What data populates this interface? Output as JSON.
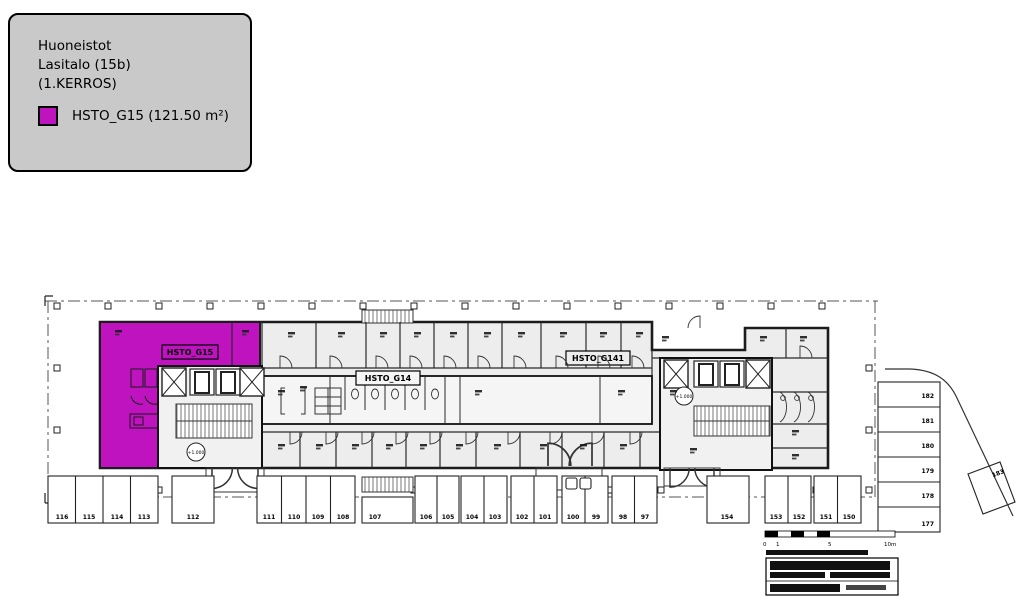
{
  "legend": {
    "title_lines": [
      "Huoneistot",
      "Lasitalo (15b)",
      "(1.KERROS)"
    ],
    "swatch_label": "HSTO_G15 (121.50 m²)",
    "swatch_color": "#c013c0"
  },
  "plan": {
    "unit_labels": {
      "g15": "HSTO_G15",
      "g14": "HSTO_G14",
      "g141": "HSTO_G141"
    },
    "level_marks": [
      "+1.000",
      "+1.000"
    ],
    "parking": {
      "bottom": [
        "116",
        "115",
        "114",
        "113",
        "112",
        "111",
        "110",
        "109",
        "108",
        "107",
        "106",
        "105",
        "104",
        "103",
        "102",
        "101",
        "100",
        "99",
        "98",
        "97",
        "154",
        "153",
        "152",
        "151",
        "150"
      ],
      "right": [
        "182",
        "181",
        "180",
        "179",
        "178",
        "177"
      ],
      "angled": "183"
    },
    "scalebar": {
      "labels": [
        "0",
        "1",
        "5",
        "10m"
      ]
    }
  },
  "colors": {
    "highlight": "#c013c0",
    "legend_bg": "#c9c9c9",
    "wall": "#1c1c1c",
    "floor_fill": "#ededed"
  }
}
